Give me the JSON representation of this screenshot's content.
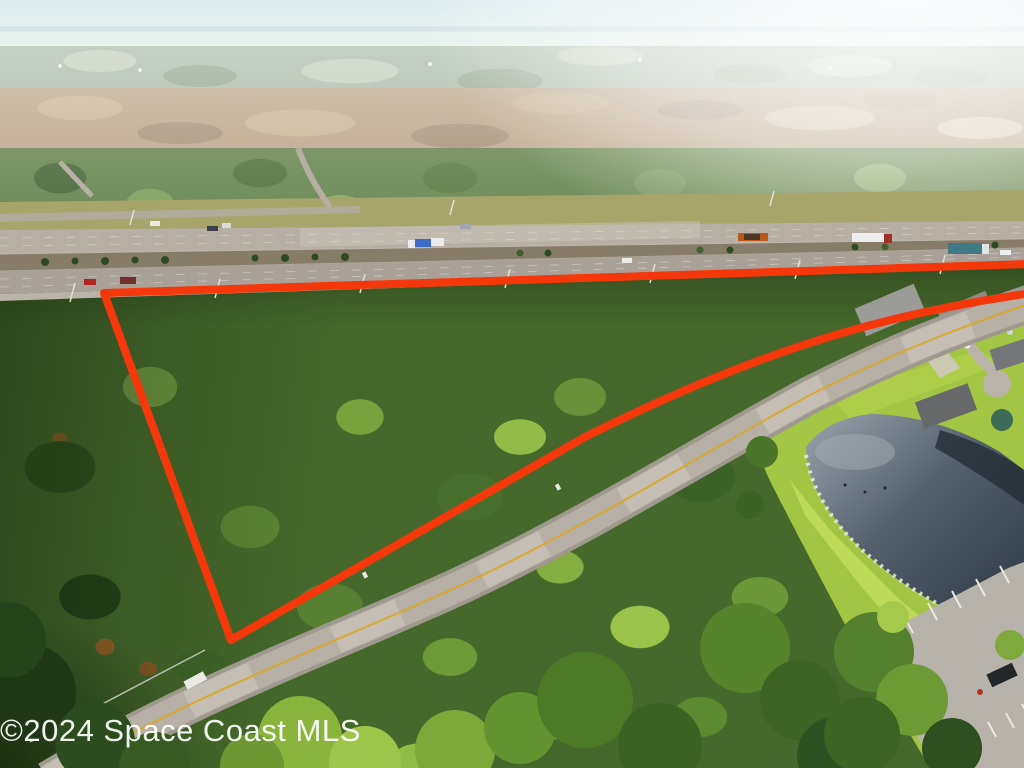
{
  "watermark": {
    "text": "©2024 Space Coast MLS"
  },
  "scene": {
    "type": "aerial-photograph",
    "objects": [
      "divided-highway",
      "median-palm-trees",
      "wooded-parcel",
      "parcel-boundary-outline",
      "two-lane-road",
      "retention-pond",
      "suburban-houses",
      "parking-lot",
      "tree-canopy"
    ]
  },
  "colors": {
    "parcel_outline": "#f4380c",
    "verge_grass": "#a8a56b",
    "highway_far_asphalt": "#b7afa4",
    "highway_median": "#877b6a",
    "highway_near_asphalt": "#a9a197",
    "highway_shoulder": "#bab3a7",
    "local_road": "#b6b0a7",
    "road_edge": "#9e988e",
    "center_line_yellow": "#d9a81f",
    "pond_light": "#9aa4ad",
    "pond_mid": "#55626e",
    "pond_dark": "#2c3741",
    "grass_bank": "#a3c544",
    "parking_pavement": "#b7b2aa",
    "riprap": "#eceade",
    "roof_dark": "#5d5f61",
    "roof_light": "#9b9b97"
  }
}
